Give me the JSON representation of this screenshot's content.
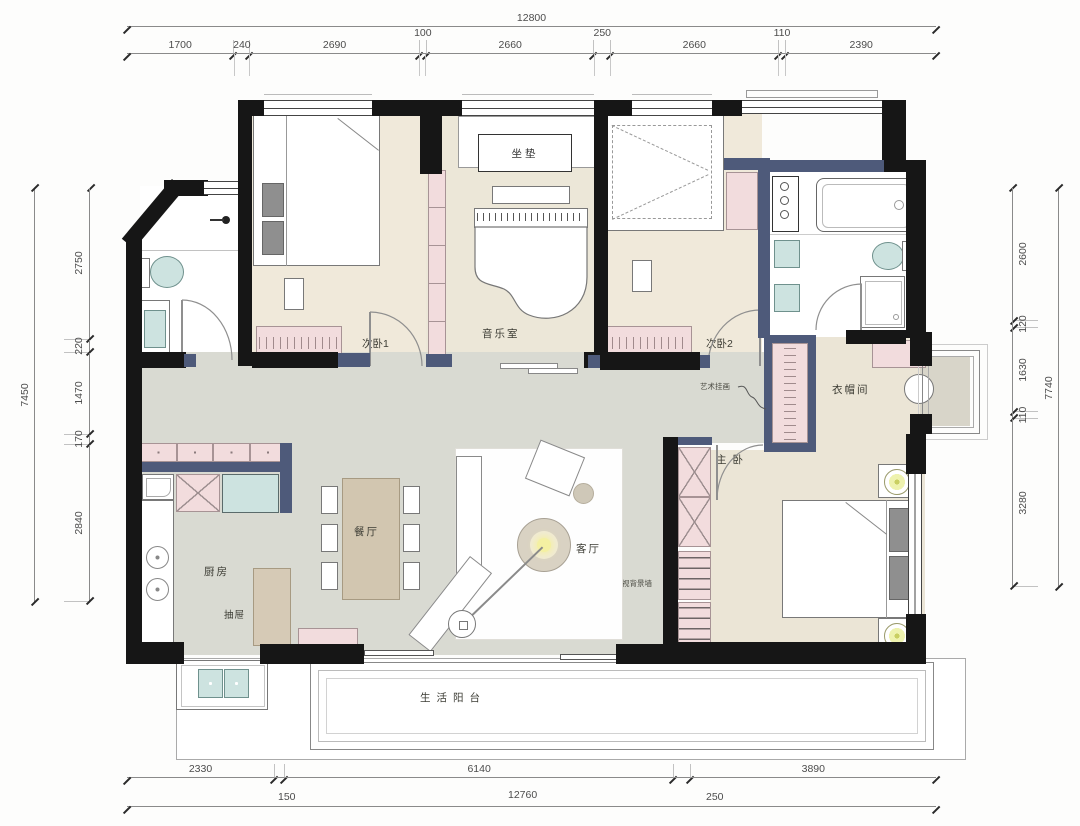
{
  "dimensions": {
    "top": {
      "total": "12800",
      "segments": [
        "1700",
        "240",
        "2690",
        "100",
        "2660",
        "250",
        "2660",
        "110",
        "2390"
      ]
    },
    "left": {
      "total": "7450",
      "segments": [
        "2750",
        "220",
        "1470",
        "170",
        "2840"
      ]
    },
    "right": {
      "total": "7740",
      "segments": [
        "2600",
        "120",
        "1630",
        "110",
        "3280"
      ]
    },
    "bottom": {
      "segments": [
        "2330",
        "6140",
        "3890"
      ],
      "sub": [
        "150",
        "12760",
        "250"
      ]
    }
  },
  "rooms": {
    "bedroom1": "次卧1",
    "music_room": "音乐室",
    "bedroom2": "次卧2",
    "cloakroom": "衣帽间",
    "master_bedroom": "主卧",
    "dining": "餐厅",
    "living": "客厅",
    "kitchen": "厨房",
    "balcony": "生活阳台"
  },
  "annotations": {
    "cushion": "坐垫",
    "drawer": "抽屉",
    "art_painting": "艺术挂画",
    "tv_wall": "储物式电视背景墙"
  },
  "colors": {
    "wall": "#161616",
    "partition": "#4e5a7a",
    "cabinet_pink": "#f2dcdd",
    "floor_warm": "#f0e9da",
    "floor_gray": "#d9dad2",
    "fixture_teal": "#cde3e0",
    "furniture_tan": "#d6cab6",
    "lamp_yellow": "#f4f0a2"
  }
}
